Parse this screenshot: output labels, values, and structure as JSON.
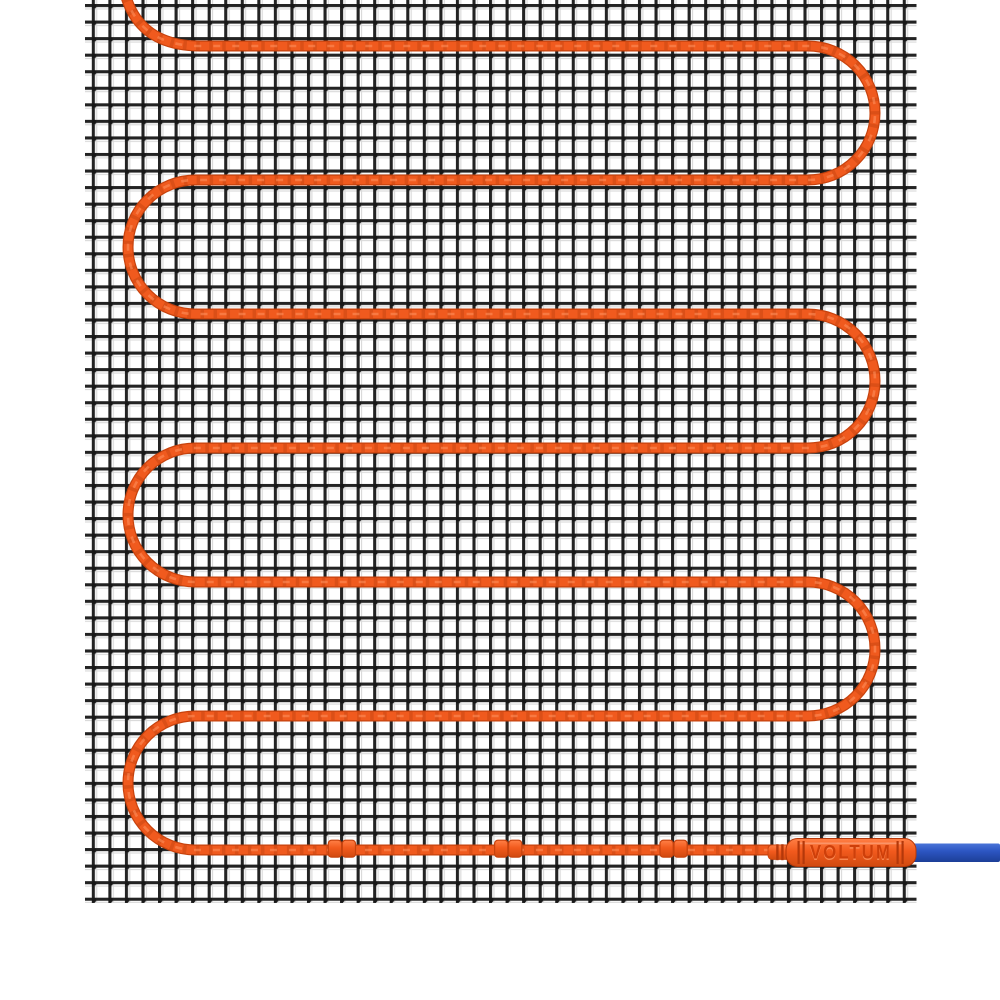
{
  "product": {
    "brand_label": "VOLTUM"
  },
  "scene": {
    "mesh_name": "wire-mesh-grid",
    "cable_name": "orange-heating-cable",
    "clip_count": 3,
    "connector_name": "voltum-connector",
    "lead_name": "blue-cold-lead-cable"
  },
  "colors": {
    "background": "#ffffff",
    "mesh_wire": "#232323",
    "mesh_node": "#171717",
    "mesh_shadow": "#d9d9d9",
    "cable_outline": "#c6420d",
    "cable_orange": "#f05a1e",
    "cable_twist": "#b9400c",
    "cable_highlight": "#ff9460",
    "connector_top": "#ff8046",
    "connector_mid": "#f25a1d",
    "connector_bottom": "#d04a10",
    "connector_ridge": "#b4380a",
    "brand_text": "#ce3f0a",
    "brand_text_highlight": "#ff9560",
    "lead_top": "#4a74d8",
    "lead_mid": "#2d56c3",
    "lead_bottom": "#1c3e97"
  }
}
